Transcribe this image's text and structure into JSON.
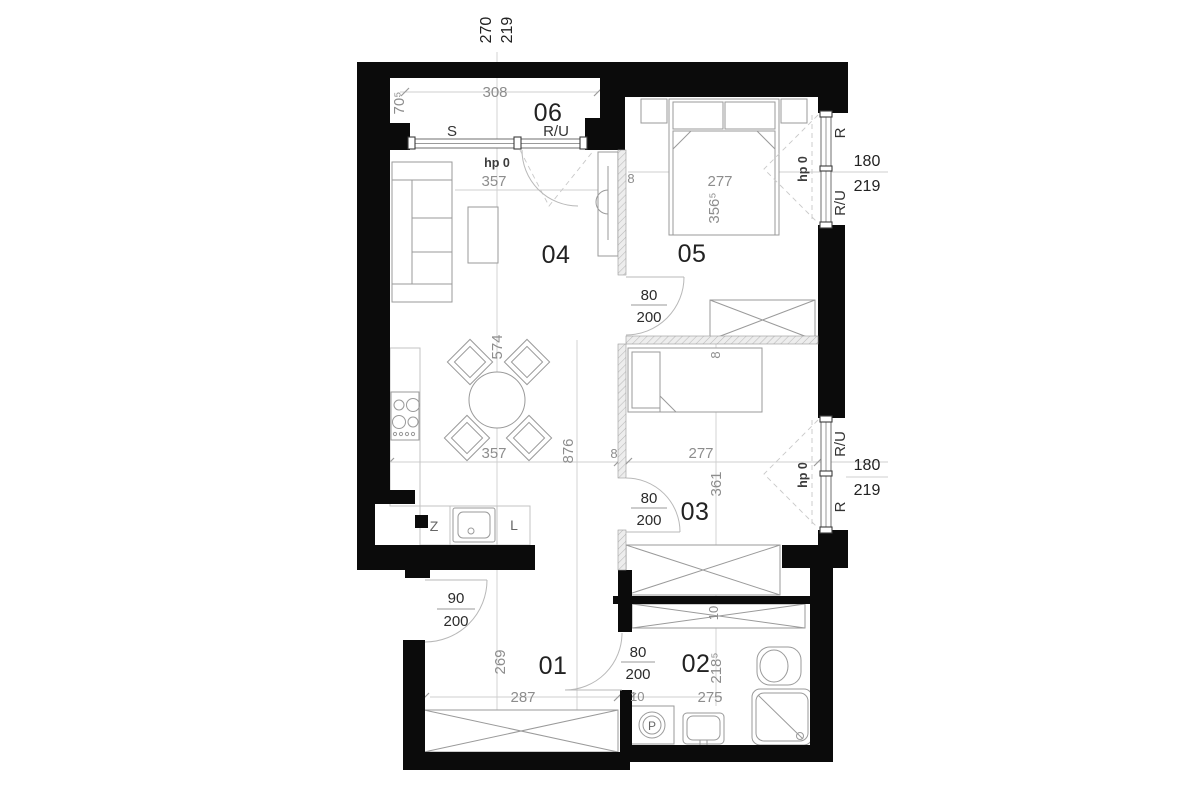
{
  "colors": {
    "wall": "#0b0b0b",
    "dimension_text": "#8d8d8d",
    "label_text": "#222222"
  },
  "top_dim": {
    "w": "270",
    "h": "219"
  },
  "loggia": {
    "number": "06",
    "width": "308",
    "depth": "70⁵",
    "panel_left": "S",
    "panel_right": "R/U"
  },
  "living": {
    "number": "04",
    "hp": "hp 0",
    "dim_top": "357",
    "dim_bottom": "357",
    "dim_table": "574",
    "dim_span": "876",
    "dim_wall": "8"
  },
  "kitchen": {
    "z_label": "Z",
    "l_label": "L"
  },
  "bedroom": {
    "number": "05",
    "width": "277",
    "length": "356⁵",
    "wall": "8",
    "door_w": "80",
    "door_h": "200",
    "win_top": "R",
    "win_bottom": "R/U",
    "win_w": "180",
    "win_h": "219",
    "hp": "hp 0"
  },
  "room3": {
    "number": "03",
    "width": "277",
    "length": "361",
    "wall_top": "8",
    "wall_bottom": "10",
    "door_w": "80",
    "door_h": "200",
    "win_top": "R/U",
    "win_bottom": "R",
    "win_w": "180",
    "win_h": "219",
    "hp": "hp 0"
  },
  "hall": {
    "number": "01",
    "width": "287",
    "length": "269",
    "door_w": "90",
    "door_h": "200",
    "bath_door_w": "80",
    "bath_door_h": "200",
    "wall": "10"
  },
  "bath": {
    "number": "02",
    "width": "275",
    "length": "218⁵",
    "washer": "P"
  }
}
